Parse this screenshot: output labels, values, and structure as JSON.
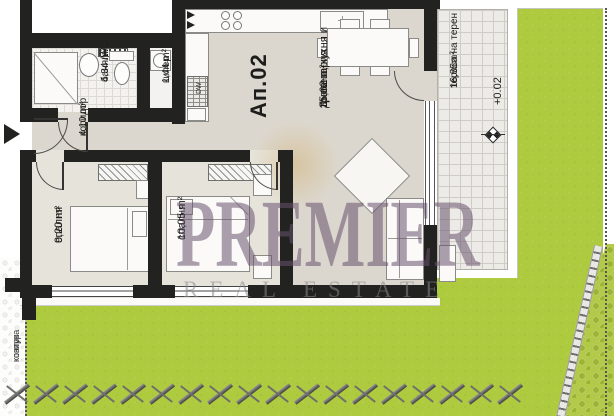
{
  "plan": {
    "unit_label": "Ап.02",
    "rooms": {
      "living": {
        "name_line1": "Дневна, кухня и",
        "name_line2": "трапезария",
        "area": "35,62 m²"
      },
      "bathroom": {
        "name": "баня/WC",
        "area": "4,34 m²"
      },
      "closet": {
        "name": "килер",
        "area": "1,44 m²"
      },
      "corridor": {
        "name": "коридор",
        "area": "4,10 m²"
      },
      "bedroom1": {
        "name": "спалня",
        "area": "9,20 m²"
      },
      "bedroom2": {
        "name": "спалня",
        "area": "10,05 m²"
      },
      "terrace": {
        "name": "тераса на терен",
        "area": "16,85m²",
        "elevation": "+0.02"
      }
    },
    "kitchen": {
      "dishwasher_label": "DW"
    },
    "site": {
      "canopy_line1": "контур",
      "canopy_line2": "козирка"
    }
  },
  "watermark": {
    "line1": "PREMIER",
    "line2": "REAL ESTATE"
  },
  "colors": {
    "wall": "#222220",
    "floor": "#dcd7ce",
    "bedroom_floor": "#e6e3db",
    "grass": "#aeca3f",
    "terrace": "#edebe7",
    "watermark": "#68526e"
  }
}
